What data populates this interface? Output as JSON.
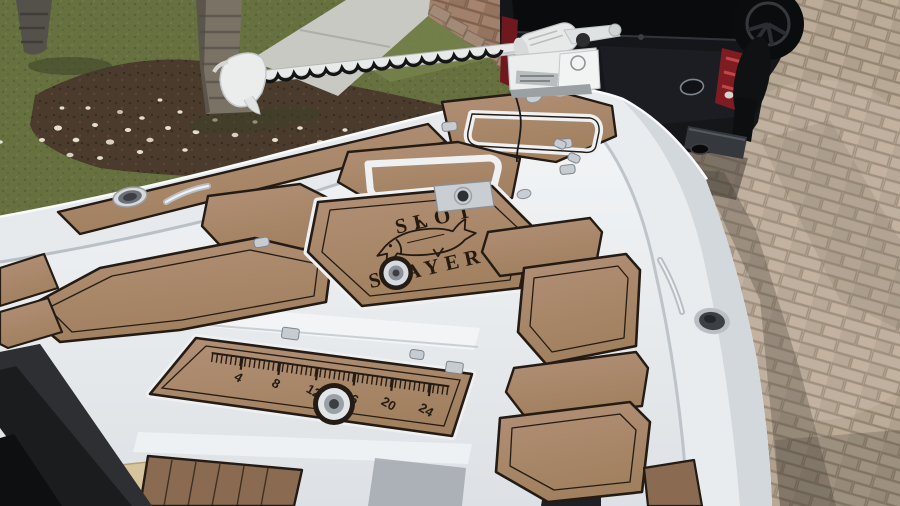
{
  "scene": {
    "type": "photograph",
    "subject": "Bow of a white bay boat with tan EVA-foam deck pads, bow-mounted trolling motor, parked on a paver driveway beside a black pickup truck, lawn with palm trunks and shell mulch bed behind"
  },
  "deck_logo": {
    "line1": "SLOT",
    "line2": "SLAYER",
    "emblem": "fish-outline"
  },
  "ruler_pad": {
    "numbers": [
      "4",
      "8",
      "12",
      "16",
      "20",
      "24"
    ]
  },
  "colors": {
    "deck_pad_tan": "#ab8a6c",
    "deck_pad_dark_brown": "#8a6b52",
    "pad_border_black": "#241c14",
    "hull_white": "#eceff1",
    "grass_green": "#67713f",
    "mulch_brown": "#4a3b2d",
    "shell_white": "#e6dfcf",
    "sidewalk_gray": "#c9c9c4",
    "paver_tan": "#b3a492",
    "paver_red": "#9b7a66",
    "truck_black": "#141519",
    "tail_light_red": "#8e2026",
    "stainless_steel": "#c7ccd1",
    "cushion_beige": "#d8c49c",
    "motor_white": "#e8eaea"
  }
}
